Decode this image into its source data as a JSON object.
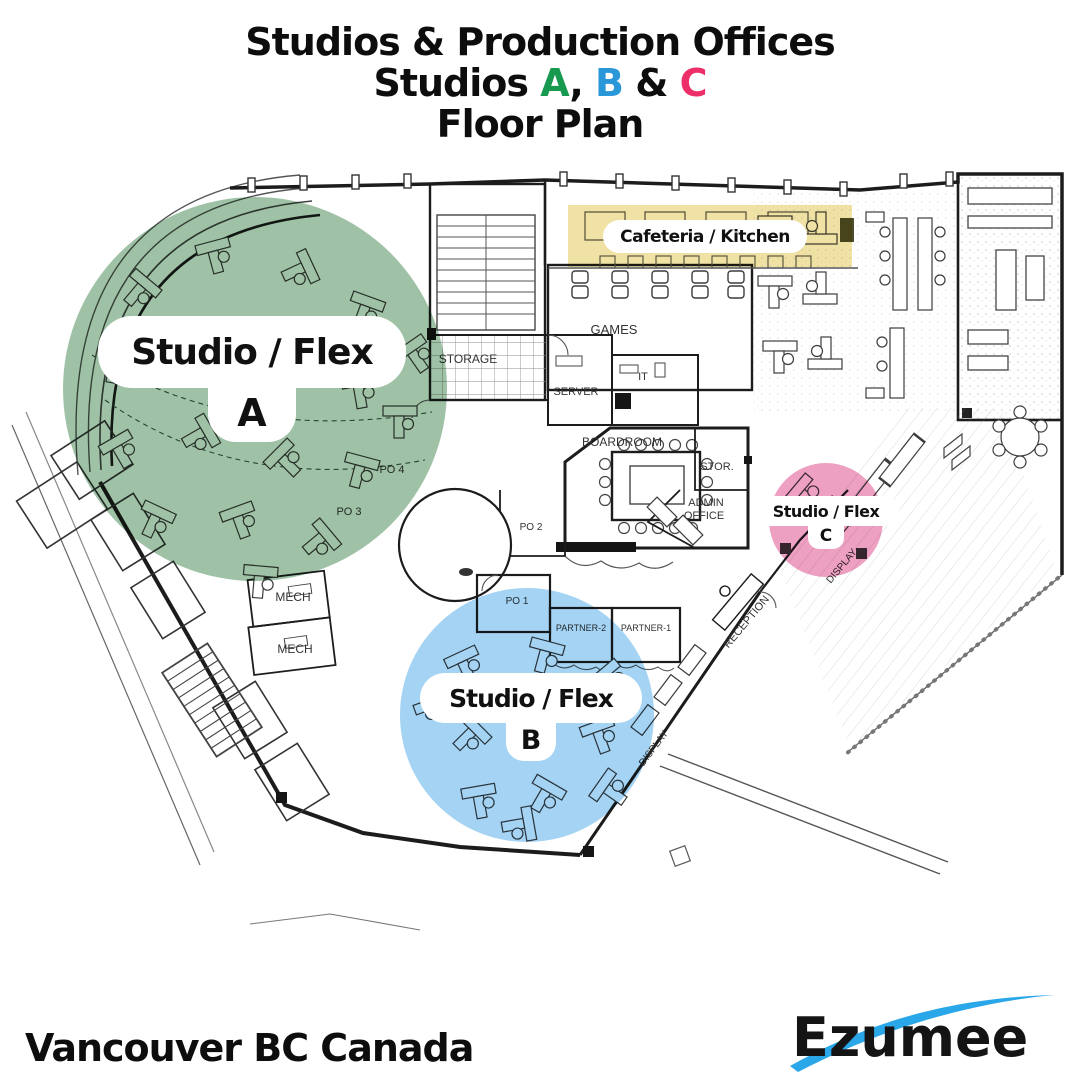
{
  "header": {
    "line1": "Studios & Production Offices",
    "line2": {
      "prefix": "Studios ",
      "a": "A",
      "comma": ", ",
      "b": "B",
      "amp": " & ",
      "c": "C"
    },
    "line3": "Floor Plan"
  },
  "zones": {
    "a": {
      "label": "Studio / Flex",
      "letter": "A",
      "overlay_color": "#9fc2a6",
      "title_color": "#17994f"
    },
    "b": {
      "label": "Studio / Flex",
      "letter": "B",
      "overlay_color": "#a5d3f3",
      "title_color": "#2a97d8"
    },
    "c": {
      "label": "Studio / Flex",
      "letter": "C",
      "overlay_color": "#eda0c1",
      "title_color": "#ee2e68"
    },
    "cafeteria": {
      "label": "Cafeteria / Kitchen",
      "overlay_color": "#efe2a4"
    }
  },
  "plan": {
    "rooms": [
      {
        "label": "GAMES"
      },
      {
        "label": "STORAGE"
      },
      {
        "label": "SERVER"
      },
      {
        "label": "IT"
      },
      {
        "label": "BOARDROOM"
      },
      {
        "label": "STOR."
      },
      {
        "label": "ADMIN"
      },
      {
        "label": "OFFICE"
      },
      {
        "label": "RECEPTION"
      },
      {
        "label": "PO 2"
      },
      {
        "label": "PO 1"
      },
      {
        "label": "PARTNER-2"
      },
      {
        "label": "PARTNER-1"
      },
      {
        "label": "PO 4"
      },
      {
        "label": "PO 3"
      },
      {
        "label": "MECH"
      },
      {
        "label": "MECH"
      },
      {
        "label": "DISPLAY"
      },
      {
        "label": "DISPLAY"
      }
    ]
  },
  "footer": {
    "location": "Vancouver BC Canada",
    "brand": "Ezumee"
  },
  "logo_colors": {
    "swoosh": "#2aa7e8",
    "text": "#141414"
  }
}
